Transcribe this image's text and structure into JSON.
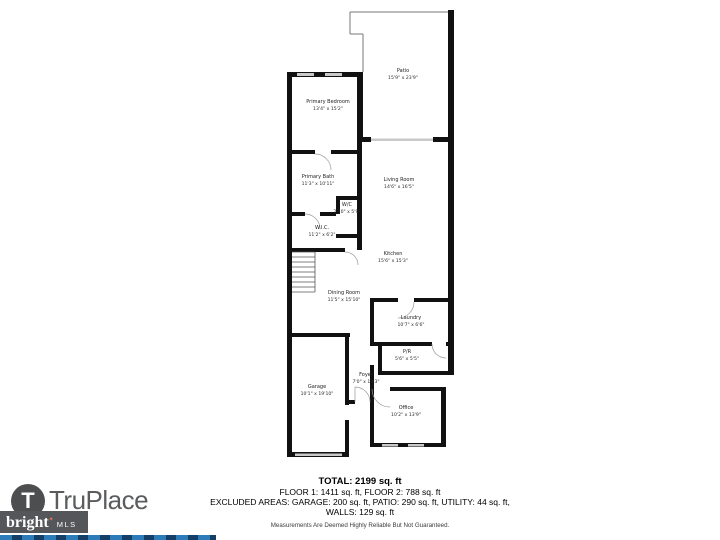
{
  "floor_plan": {
    "rooms": [
      {
        "id": "patio",
        "name": "Patio",
        "dims": "15'9\" x 23'9\""
      },
      {
        "id": "primary-bedroom",
        "name": "Primary Bedroom",
        "dims": "13'4\" x 15'2\""
      },
      {
        "id": "primary-bath",
        "name": "Primary Bath",
        "dims": "11'3\" x 10'11\""
      },
      {
        "id": "wc",
        "name": "W/C",
        "dims": "2'10\" x 5'9\""
      },
      {
        "id": "wic",
        "name": "W.I.C.",
        "dims": "11'2\" x 6'2\""
      },
      {
        "id": "living-room",
        "name": "Living Room",
        "dims": "14'6\" x 16'5\""
      },
      {
        "id": "kitchen",
        "name": "Kitchen",
        "dims": "15'6\" x 15'3\""
      },
      {
        "id": "dining-room",
        "name": "Dining Room",
        "dims": "11'5\" x 15'10\""
      },
      {
        "id": "laundry",
        "name": "Laundry",
        "dims": "10'7\" x 6'6\""
      },
      {
        "id": "pr",
        "name": "P/R",
        "dims": "5'6\" x 5'5\""
      },
      {
        "id": "foyer",
        "name": "Foyer",
        "dims": "7'0\" x 13'3\""
      },
      {
        "id": "garage",
        "name": "Garage",
        "dims": "10'1\" x 19'10\""
      },
      {
        "id": "office",
        "name": "Office",
        "dims": "10'2\" x 13'9\""
      }
    ]
  },
  "summary": {
    "total": "TOTAL: 2199 sq. ft",
    "floors": "FLOOR 1: 1411 sq. ft, FLOOR 2: 788 sq. ft",
    "excluded": "EXCLUDED AREAS: GARAGE: 200 sq. ft, PATIO: 290 sq. ft, UTILITY: 44 sq. ft,",
    "walls": "WALLS: 129 sq. ft",
    "disclaimer": "Measurements Are Deemed Highly Reliable But Not Guaranteed."
  },
  "branding": {
    "truplace": {
      "name": "TruPlace",
      "monogram": "T"
    },
    "bright_mls": {
      "word": "bright",
      "suffix": "MLS",
      "star": "✦"
    },
    "colors": {
      "logo_gray": "#55565a",
      "accent_orange": "#e8744a",
      "strip_blue": "#2d7cba",
      "strip_navy": "#163f66",
      "wall_black": "#111111",
      "window_gray": "#c9c9c9"
    }
  }
}
